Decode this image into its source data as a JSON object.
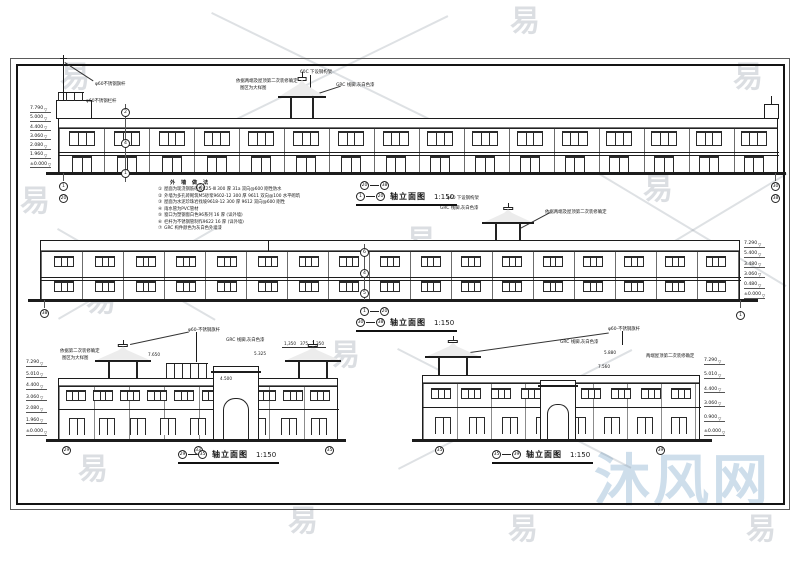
{
  "meta": {
    "level_marker": "▽",
    "line_color": "#1c1c1c",
    "watermark_gray": "#8791a0",
    "watermark_blue": "#98bad6",
    "paper_color": "#ffffff"
  },
  "watermark": {
    "glyph": "易",
    "brand": "沐风网"
  },
  "titles": {
    "d1": {
      "pre_a": "20",
      "pre_b": "38",
      "a": "1",
      "b": "20",
      "text": "轴立面图",
      "scale": "1:150"
    },
    "d2": {
      "pre_a": "1",
      "pre_b": "20",
      "a": "30",
      "b": "38",
      "text": "轴立面图",
      "scale": "1:150"
    },
    "d3": {
      "a": "29",
      "b": "35",
      "text": "轴立面图",
      "scale": "1:150"
    },
    "d4": {
      "a": "35",
      "b": "39",
      "text": "轴立面图",
      "scale": "1:150"
    }
  },
  "annotations": {
    "d1_flag": "φ60不锈钢旗杆",
    "d1_rail": "φ60不锈钢栏杆",
    "d1_fit": "依据两端及屋顶第二次装修确定",
    "d1_fit2": "图区为大样图",
    "d1_steel": "60C 下设钢构架",
    "d1_grc": "GRC 线脚,灰白色漆",
    "d2_steel": "φ60 下设钢构架",
    "d2_grc": "GRC 线脚,灰白色漆",
    "d2_fit": "依据两端及屋顶第二次装修确定",
    "d3_fit": "依据第二次装修确定",
    "d3_fit2": "图区为大样图",
    "d3_flag": "φ60-不锈钢旗杆",
    "d3_grc": "GRC 线脚,灰白色漆",
    "d4_flag": "φ60-不锈钢旗杆",
    "d4_grc": "GRC 线脚,灰白色漆",
    "d4_fit": "两端屋顶第二次装修确定"
  },
  "levels": {
    "d1": [
      "7.790",
      "5.000",
      "4.400",
      "3.060",
      "2.080",
      "1.960",
      "±0.000"
    ],
    "d2": [
      "7.290",
      "5.400",
      "3.480",
      "3.060",
      "0.480",
      "±0.000"
    ],
    "d3": [
      "7.290",
      "5.010",
      "4.400",
      "3.060",
      "2.080",
      "1.960",
      "±0.000"
    ],
    "d4": [
      "7.290",
      "5.010",
      "4.400",
      "3.060",
      "0.900",
      "±0.000"
    ]
  },
  "dims": {
    "d3": [
      "7.650",
      "5.325",
      "1,350",
      "375",
      "1,350",
      "4.500"
    ],
    "d4": [
      "5.880",
      "7.560"
    ]
  },
  "notes": {
    "title": "外 墙 做 法",
    "items": [
      "屋面为现浇钢筋砼板C25-Ⅲ 300 厚 31a 双向@600 刚性防水",
      "外墙为多孔砖砌筑M5砂浆9602-12 300 厚 9611 双向@100 水平砌筑",
      "屋面为水泥珍珠岩找坡9618-12 300 厚 9612 双向@600 刚性",
      "雨水管为PVC管材",
      "窗口为塑钢窗白色96系列 16 厚 (详外墙)",
      "栏杆为不锈钢管制作9622 16 厚 (详外墙)",
      "GRC 构件颜色为灰白色外墙漆"
    ]
  },
  "axes": {
    "d1_left": [
      "1",
      "20"
    ],
    "d1_mid": [
      "2"
    ],
    "d1_right": [
      "30",
      "38"
    ],
    "d2_left": [
      "38"
    ],
    "d2_right": [
      "1"
    ],
    "d3_bottom": [
      "29",
      "33",
      "35"
    ],
    "d4_bottom": [
      "35",
      "39"
    ],
    "d1_refs": [
      "2",
      "4",
      "1"
    ],
    "d2_refs": [
      "6",
      "4",
      "5"
    ]
  },
  "facades": {
    "d1_upper": {
      "count": 16,
      "cls": "w3",
      "name": "upper-window"
    },
    "d1_lower": {
      "count": 16,
      "cls": "door",
      "name": "storefront-door"
    },
    "d2_upper": {
      "count": 17,
      "cls": "w3s",
      "name": "upper-window"
    },
    "d2_lower": {
      "count": 17,
      "cls": "w3s",
      "name": "lower-window"
    },
    "d3_upper": {
      "count": 10,
      "cls": "w3s",
      "name": "upper-window"
    },
    "d3_lower": {
      "count": 9,
      "cls": "w2",
      "name": "lower-window"
    },
    "d4_upper": {
      "count": 9,
      "cls": "w3s",
      "name": "upper-window"
    },
    "d4_lower": {
      "count": 8,
      "cls": "w2",
      "name": "lower-window"
    }
  }
}
